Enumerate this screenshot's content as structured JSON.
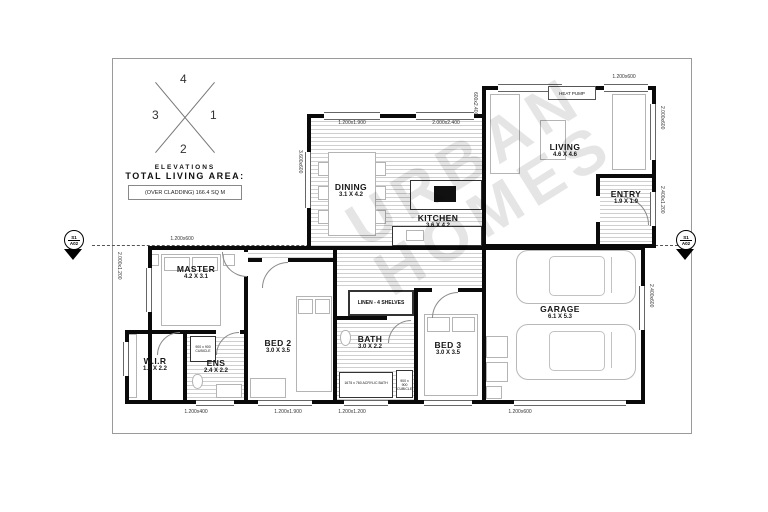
{
  "watermark": {
    "line1": "URBAN",
    "line2": "HOMES"
  },
  "title_block": {
    "area_label": "TOTAL LIVING AREA:",
    "area_value": "(OVER CLADDING) 166.4 SQ M",
    "elevations_caption": "ELEVATIONS",
    "elevation_top": "4",
    "elevation_right": "1",
    "elevation_bottom": "2",
    "elevation_left": "3"
  },
  "section_markers": {
    "left_top": "S1",
    "left_bottom": "A02",
    "right_top": "S1",
    "right_bottom": "A02"
  },
  "rooms": [
    {
      "name": "MASTER",
      "dims": "4.2 X 3.1"
    },
    {
      "name": "W.I.R",
      "dims": "1.8 X 2.2"
    },
    {
      "name": "ENS",
      "dims": "2.4 X 2.2"
    },
    {
      "name": "BED 2",
      "dims": "3.0 X 3.5"
    },
    {
      "name": "BATH",
      "dims": "3.0 X 2.2"
    },
    {
      "name": "BED 3",
      "dims": "3.0 X 3.5"
    },
    {
      "name": "DINING",
      "dims": "3.1 X 4.2"
    },
    {
      "name": "KITCHEN",
      "dims": "3.6 X 4.2"
    },
    {
      "name": "LIVING",
      "dims": "4.6 X 4.6"
    },
    {
      "name": "ENTRY",
      "dims": "1.9 X 1.9"
    },
    {
      "name": "GARAGE",
      "dims": "6.1 X 5.3"
    }
  ],
  "fixtures": {
    "linen": "LINEN - 4 SHELVES",
    "heat_pump": "HEAT PUMP",
    "ens_cubicle": "900 x 900 CUBICLE",
    "bath_cubicle": "900 x 900 CUBICLE",
    "acrylic_bath": "1675 x 760 ACRYLIC BATH"
  },
  "dimension_labels": {
    "top_master": "1.200x600",
    "top_dining": "1.200x1.900",
    "top_kitchen": "2.000x2.400",
    "top_living": "1.200x600",
    "bottom_1": "1.200x400",
    "bottom_2": "1.200x1.900",
    "bottom_3": "1.200x1.200",
    "bottom_4": "1.200x600",
    "left_master": "2.000x1.200",
    "left_dining": "3.600x600",
    "left_living": "600x2.400",
    "right_living": "2.000x600",
    "right_entry": "2.400x1.200",
    "right_garage": "2.400x600"
  }
}
